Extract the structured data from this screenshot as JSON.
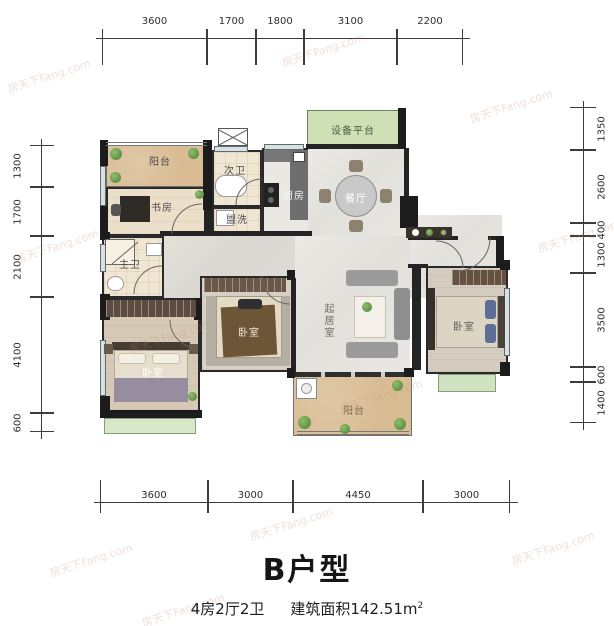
{
  "title": "B户型",
  "subtitle": {
    "layout": "4房2厅2卫",
    "area": "建筑面积142.51m",
    "area_sup": "2"
  },
  "watermark": "房天下Fang.com",
  "dimensions": {
    "top": [
      "3600",
      "1700",
      "1800",
      "3100",
      "2200"
    ],
    "bottom": [
      "3600",
      "3000",
      "4450",
      "3000"
    ],
    "left": [
      "1300",
      "1700",
      "2100",
      "4100",
      "600"
    ],
    "right": [
      "1350",
      "2600",
      "400",
      "1300",
      "3500",
      "600",
      "1400"
    ]
  },
  "rooms": {
    "balcony_top": "阳台",
    "study": "书房",
    "bath2": "次卫",
    "wash": "盥洗",
    "kitchen": "厨房",
    "equipment": "设备平台",
    "dining": "餐厅",
    "master_bath": "主卫",
    "bedroom_left": "卧室",
    "bedroom_mid": "卧室",
    "bedroom_right": "卧室",
    "living": "起居室",
    "balcony_bottom": "阳台"
  },
  "palette": {
    "wall": "#242424",
    "balcony_floor": "#d9bc93",
    "marble_floor": "#e6e4e0",
    "wood_floor": "#d6c9b6",
    "tile_floor": "#f1e6d2",
    "green_area": "#cfe0b5",
    "wardrobe": "#5c4c3f"
  }
}
